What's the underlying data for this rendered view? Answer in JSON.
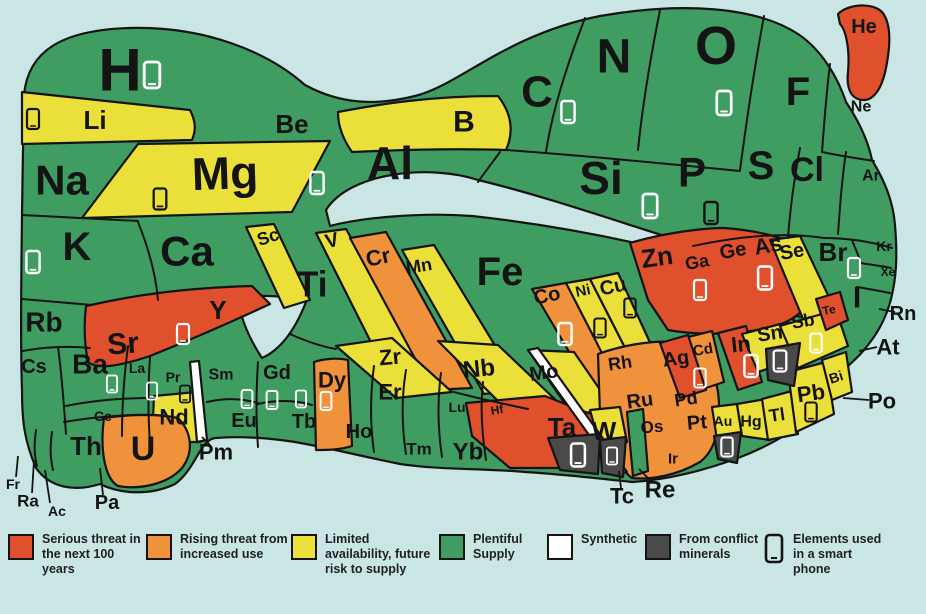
{
  "title": "Element scarcity periodic table",
  "palette": {
    "background": "#c9e6e4",
    "outline": "#141414",
    "serious": "#e0502d",
    "rising": "#f0913c",
    "limited": "#ebdf3a",
    "plentiful": "#3f9d62",
    "synthetic": "#ffffff",
    "conflict": "#4a4a4a",
    "phone_white": "#ffffff",
    "phone_black": "#141414"
  },
  "legend": {
    "items": [
      {
        "swatch": "serious",
        "label": "Serious threat in the next 100 years"
      },
      {
        "swatch": "rising",
        "label": "Rising threat from increased use"
      },
      {
        "swatch": "limited",
        "label": "Limited availability, future risk to supply"
      },
      {
        "swatch": "plentiful",
        "label": "Plentiful Supply"
      },
      {
        "swatch": "synthetic",
        "label": "Synthetic"
      },
      {
        "swatch": "conflict",
        "label": "From conflict minerals"
      },
      {
        "swatch": "phone",
        "label": "Elements used in a smart phone"
      }
    ]
  },
  "elements": [
    {
      "symbol": "H",
      "category": "plentiful",
      "phone": true
    },
    {
      "symbol": "He",
      "category": "serious",
      "phone": false
    },
    {
      "symbol": "Li",
      "category": "limited",
      "phone": true
    },
    {
      "symbol": "Be",
      "category": "plentiful",
      "phone": false
    },
    {
      "symbol": "B",
      "category": "limited",
      "phone": false
    },
    {
      "symbol": "C",
      "category": "plentiful",
      "phone": true
    },
    {
      "symbol": "N",
      "category": "plentiful",
      "phone": false
    },
    {
      "symbol": "O",
      "category": "plentiful",
      "phone": true
    },
    {
      "symbol": "F",
      "category": "plentiful",
      "phone": false
    },
    {
      "symbol": "Ne",
      "category": "plentiful",
      "phone": false
    },
    {
      "symbol": "Na",
      "category": "plentiful",
      "phone": false
    },
    {
      "symbol": "Mg",
      "category": "limited",
      "phone": true
    },
    {
      "symbol": "Al",
      "category": "plentiful",
      "phone": true
    },
    {
      "symbol": "Si",
      "category": "plentiful",
      "phone": true
    },
    {
      "symbol": "P",
      "category": "limited",
      "phone": true
    },
    {
      "symbol": "S",
      "category": "plentiful",
      "phone": false
    },
    {
      "symbol": "Cl",
      "category": "plentiful",
      "phone": false
    },
    {
      "symbol": "Ar",
      "category": "plentiful",
      "phone": false
    },
    {
      "symbol": "K",
      "category": "plentiful",
      "phone": true
    },
    {
      "symbol": "Ca",
      "category": "plentiful",
      "phone": false
    },
    {
      "symbol": "Sc",
      "category": "limited",
      "phone": false
    },
    {
      "symbol": "Ti",
      "category": "plentiful",
      "phone": false
    },
    {
      "symbol": "V",
      "category": "limited",
      "phone": false
    },
    {
      "symbol": "Cr",
      "category": "rising",
      "phone": false
    },
    {
      "symbol": "Mn",
      "category": "limited",
      "phone": false
    },
    {
      "symbol": "Fe",
      "category": "plentiful",
      "phone": false
    },
    {
      "symbol": "Co",
      "category": "rising",
      "phone": true
    },
    {
      "symbol": "Ni",
      "category": "limited",
      "phone": true
    },
    {
      "symbol": "Cu",
      "category": "limited",
      "phone": true
    },
    {
      "symbol": "Zn",
      "category": "serious",
      "phone": false
    },
    {
      "symbol": "Ga",
      "category": "serious",
      "phone": true
    },
    {
      "symbol": "Ge",
      "category": "serious",
      "phone": false
    },
    {
      "symbol": "As",
      "category": "serious",
      "phone": true
    },
    {
      "symbol": "Se",
      "category": "limited",
      "phone": false
    },
    {
      "symbol": "Br",
      "category": "plentiful",
      "phone": true
    },
    {
      "symbol": "Kr",
      "category": "plentiful",
      "phone": false
    },
    {
      "symbol": "Rb",
      "category": "plentiful",
      "phone": false
    },
    {
      "symbol": "Sr",
      "category": "serious",
      "phone": false
    },
    {
      "symbol": "Y",
      "category": "serious",
      "phone": true
    },
    {
      "symbol": "Zr",
      "category": "limited",
      "phone": false
    },
    {
      "symbol": "Nb",
      "category": "limited",
      "phone": false
    },
    {
      "symbol": "Mo",
      "category": "limited",
      "phone": false
    },
    {
      "symbol": "Tc",
      "category": "synthetic",
      "phone": false,
      "label_outside": true
    },
    {
      "symbol": "Ru",
      "category": "rising",
      "phone": false
    },
    {
      "symbol": "Rh",
      "category": "rising",
      "phone": false
    },
    {
      "symbol": "Pd",
      "category": "rising",
      "phone": false
    },
    {
      "symbol": "Ag",
      "category": "serious",
      "phone": true
    },
    {
      "symbol": "Cd",
      "category": "rising",
      "phone": false
    },
    {
      "symbol": "In",
      "category": "serious",
      "phone": true
    },
    {
      "symbol": "Sn",
      "category": "limited",
      "phone": true,
      "conflict": true
    },
    {
      "symbol": "Sb",
      "category": "limited",
      "phone": true
    },
    {
      "symbol": "Te",
      "category": "serious",
      "phone": false
    },
    {
      "symbol": "I",
      "category": "plentiful",
      "phone": false
    },
    {
      "symbol": "Xe",
      "category": "plentiful",
      "phone": false
    },
    {
      "symbol": "Cs",
      "category": "plentiful",
      "phone": false
    },
    {
      "symbol": "Ba",
      "category": "plentiful",
      "phone": false
    },
    {
      "symbol": "La",
      "category": "plentiful",
      "phone": true
    },
    {
      "symbol": "Ce",
      "category": "plentiful",
      "phone": false
    },
    {
      "symbol": "Pr",
      "category": "plentiful",
      "phone": true
    },
    {
      "symbol": "Nd",
      "category": "limited",
      "phone": true
    },
    {
      "symbol": "Pm",
      "category": "synthetic",
      "phone": false,
      "label_outside": true
    },
    {
      "symbol": "Sm",
      "category": "plentiful",
      "phone": false
    },
    {
      "symbol": "Eu",
      "category": "plentiful",
      "phone": true
    },
    {
      "symbol": "Gd",
      "category": "plentiful",
      "phone": true
    },
    {
      "symbol": "Tb",
      "category": "plentiful",
      "phone": true
    },
    {
      "symbol": "Dy",
      "category": "rising",
      "phone": true
    },
    {
      "symbol": "Ho",
      "category": "plentiful",
      "phone": false
    },
    {
      "symbol": "Er",
      "category": "plentiful",
      "phone": false
    },
    {
      "symbol": "Tm",
      "category": "plentiful",
      "phone": false
    },
    {
      "symbol": "Yb",
      "category": "plentiful",
      "phone": false
    },
    {
      "symbol": "Lu",
      "category": "plentiful",
      "phone": false
    },
    {
      "symbol": "Hf",
      "category": "serious",
      "phone": false
    },
    {
      "symbol": "Ta",
      "category": "serious",
      "phone": true,
      "conflict": true
    },
    {
      "symbol": "W",
      "category": "limited",
      "phone": true,
      "conflict": true
    },
    {
      "symbol": "Re",
      "category": "plentiful",
      "phone": false,
      "label_outside": true
    },
    {
      "symbol": "Os",
      "category": "rising",
      "phone": false
    },
    {
      "symbol": "Ir",
      "category": "rising",
      "phone": false
    },
    {
      "symbol": "Pt",
      "category": "rising",
      "phone": false
    },
    {
      "symbol": "Au",
      "category": "limited",
      "phone": true,
      "conflict": true
    },
    {
      "symbol": "Hg",
      "category": "limited",
      "phone": false
    },
    {
      "symbol": "Tl",
      "category": "limited",
      "phone": false
    },
    {
      "symbol": "Pb",
      "category": "limited",
      "phone": true
    },
    {
      "symbol": "Bi",
      "category": "limited",
      "phone": false
    },
    {
      "symbol": "Po",
      "category": "plentiful",
      "phone": false,
      "label_outside": true
    },
    {
      "symbol": "At",
      "category": "plentiful",
      "phone": false,
      "label_outside": true
    },
    {
      "symbol": "Rn",
      "category": "plentiful",
      "phone": false,
      "label_outside": true
    },
    {
      "symbol": "Fr",
      "category": "plentiful",
      "phone": false,
      "label_outside": true
    },
    {
      "symbol": "Ra",
      "category": "plentiful",
      "phone": false,
      "label_outside": true
    },
    {
      "symbol": "Ac",
      "category": "plentiful",
      "phone": false,
      "label_outside": true
    },
    {
      "symbol": "Th",
      "category": "plentiful",
      "phone": false
    },
    {
      "symbol": "Pa",
      "category": "plentiful",
      "phone": false,
      "label_outside": true
    },
    {
      "symbol": "U",
      "category": "rising",
      "phone": false
    }
  ]
}
